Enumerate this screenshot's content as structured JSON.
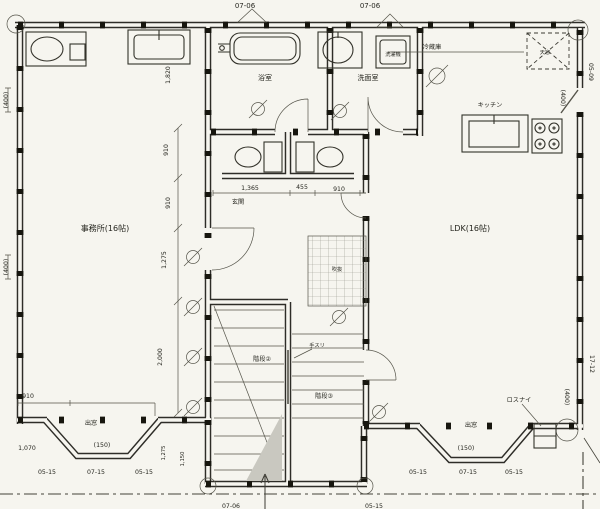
{
  "plan": {
    "rooms": {
      "office": {
        "label": "事務所(16帖)"
      },
      "ldk": {
        "label": "LDK(16帖)"
      },
      "bathroom": {
        "label": "浴室"
      },
      "washroom": {
        "label": "洗面室"
      },
      "kitchen": {
        "label": "キッチン"
      },
      "entrance": {
        "label": "玄関"
      },
      "stair_left": {
        "label": "階段②"
      },
      "stair_right": {
        "label": "階段③"
      },
      "void": {
        "label": "吹抜"
      }
    },
    "annotations": {
      "refrigerator": "冷蔵庫",
      "washing_machine": "洗濯機",
      "skylight": "天窓",
      "handrail": "手スリ",
      "lossnay": "ロスナイ",
      "bay_left": "出窓",
      "bay_right": "出窓"
    },
    "grid_labels": {
      "top_1": "07-06",
      "top_2": "07-06",
      "right_top": "05-09",
      "right_bottom": "17-12",
      "bottom_left": [
        "05-15",
        "07-15",
        "05-15"
      ],
      "bottom_right": [
        "05-15",
        "07-15",
        "05-15"
      ],
      "bottom_mid_1": "07-06",
      "bottom_mid_2": "05-15"
    },
    "dimensions": {
      "left_top": "(400)",
      "left_mid": "(400)",
      "right_upper": "(400)",
      "right_lower": "(400)",
      "upper_1820": "1,820",
      "col_910a": "910",
      "col_910b": "910",
      "col_1275": "1,275",
      "col_2000": "2,000",
      "mid_1365": "1,365",
      "mid_455": "455",
      "mid_910": "910",
      "bay_910": "910",
      "bay_1070": "1,070",
      "bay_150_l": "(150)",
      "bay_150_r": "(150)",
      "stair_1275": "1,275",
      "stair_1150": "1,150"
    }
  }
}
